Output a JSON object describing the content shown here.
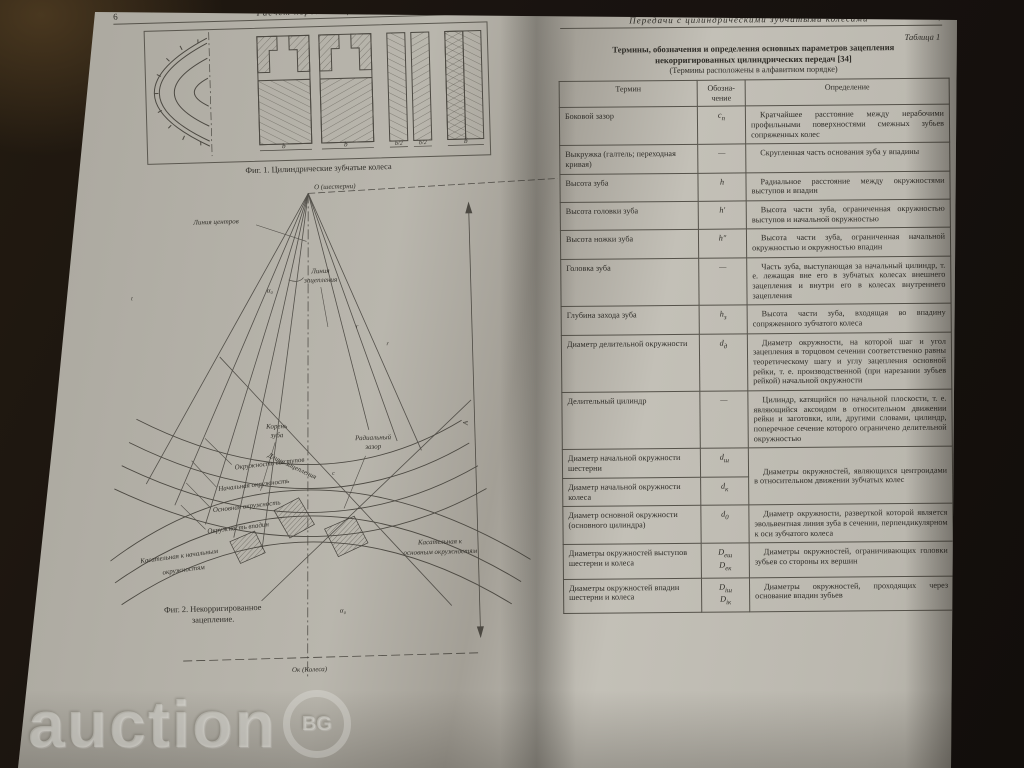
{
  "watermark": {
    "text": "auction",
    "badge": "BG"
  },
  "colors": {
    "page": "#b9b6ad",
    "background": "#191310",
    "ink": "#2f2d28",
    "rule": "#55524a"
  },
  "left_page": {
    "page_number": "6",
    "running_title": "Расчет передач зацеплением",
    "fig1": {
      "caption": "Фиг. 1. Цилиндрические зубчатые колеса",
      "dim_b": "b",
      "dim_b2": "b/2"
    },
    "fig2": {
      "caption_l1": "Фиг. 2. Некорригированное",
      "caption_l2": "зацепление.",
      "labels": {
        "o_pinion": "О (шестерни)",
        "o_wheel": "Ок (Колеса)",
        "line_of_centers": "Линия центров",
        "engagement_line_l1": "Линия",
        "engagement_line_l2": "зацепления",
        "engagement_length": "Длина зацепления",
        "alpha": "α₀",
        "tooth_root_l1": "Корень",
        "tooth_root_l2": "зуба",
        "radial_clearance_l1": "Радиальный",
        "radial_clearance_l2": "зазор",
        "clearance_c": "с",
        "pitch_t": "t",
        "r_label": "r",
        "circle_tips": "Окружность выступов",
        "pitch_circle": "Начальная окружность",
        "base_circle": "Основная окружность",
        "root_circle": "Окружность впадин",
        "tangent_pitch_l1": "Касательная к начальным",
        "tangent_pitch_l2": "окружностям",
        "tangent_base_l1": "Касательная к",
        "tangent_base_l2": "основным окружностям",
        "dim_A": "А"
      }
    }
  },
  "right_page": {
    "page_number": "7",
    "running_title": "Передачи с цилиндрическими зубчатыми колесами",
    "table_ref": "Таблица 1",
    "title_l1": "Термины, обозначения и определения основных параметров зацепления",
    "title_l2": "некорригированных цилиндрических передач [34]",
    "title_l3": "(Термины расположены в алфавитном порядке)",
    "table": {
      "headers": {
        "term": "Термин",
        "sym_l1": "Обозна-",
        "sym_l2": "чение",
        "definition": "Определение"
      },
      "rows": [
        {
          "term": "Боковой зазор",
          "sym": "c",
          "sub": "n",
          "def": "Кратчайшее расстояние между нерабочими профильными поверхностями смежных зубьев сопряженных колес"
        },
        {
          "term": "Выкружка (галтель; переходная кривая)",
          "sym": "—",
          "def": "Скругленная часть основания зуба у впадины"
        },
        {
          "term": "Высота зуба",
          "sym": "h",
          "def": "Радиальное расстояние между окружностями выступов и впадин"
        },
        {
          "term": "Высота головки зуба",
          "sym": "h′",
          "def": "Высота части зуба, ограниченная окружностью выступов и начальной окружностью"
        },
        {
          "term": "Высота ножки зуба",
          "sym": "h″",
          "def": "Высота части зуба, ограниченная начальной окружностью и окружностью впадин"
        },
        {
          "term": "Головка зуба",
          "sym": "—",
          "def": "Часть зуба, выступающая за начальный цилиндр, т. е. лежащая вне его в зубчатых колесах внешнего зацепления и внутри его в колесах внутреннего зацепления"
        },
        {
          "term": "Глубина захода зуба",
          "sym": "h",
          "sub": "з",
          "def": "Высота части зуба, входящая во впадину сопряженного зубчатого колеса"
        },
        {
          "term": "Диаметр делительной окружности",
          "sym": "d",
          "sub": "д",
          "def": "Диаметр окружности, на которой шаг и угол зацепления в торцовом сечении соответственно равны теоретическому шагу и углу зацепления основной рейки, т. е. производственной (при нарезании зубьев рейкой) начальной окружности"
        },
        {
          "term": "Делительный цилиндр",
          "sym": "—",
          "def": "Цилиндр, катящийся по начальной плоскости, т. е. являющийся аксоидом в относительном движении рейки и заготовки, или, другими словами, цилиндр, поперечное сечение которого ограничено делительной окружностью"
        },
        {
          "term": "Диаметр начальной окружности шестерни",
          "sym": "d",
          "sub": "ш",
          "def": "Диаметры окружностей, являющихся центроидами в относительном движении зубчатых колес"
        },
        {
          "term": "Диаметр начальной окружности колеса",
          "sym": "d",
          "sub": "к"
        },
        {
          "term": "Диаметр основной окружности (основного цилиндра)",
          "sym": "d",
          "sub": "0",
          "def": "Диаметр окружности, разверткой которой является эвольвентная линия зуба в сечении, перпендикулярном к оси зубчатого колеса"
        },
        {
          "term": "Диаметры окружностей выступов шестерни и колеса",
          "sym": "D",
          "sub": "еш",
          "sym2": "D",
          "sub2": "ек",
          "def": "Диаметры окружностей, ограничивающих головки зубьев со стороны их вершин"
        },
        {
          "term": "Диаметры окружностей впадин шестерни и колеса",
          "sym": "D",
          "sub": "iш",
          "sym2": "D",
          "sub2": "iк",
          "def": "Диаметры окружностей, проходящих через основание впадин зубьев"
        }
      ]
    }
  }
}
